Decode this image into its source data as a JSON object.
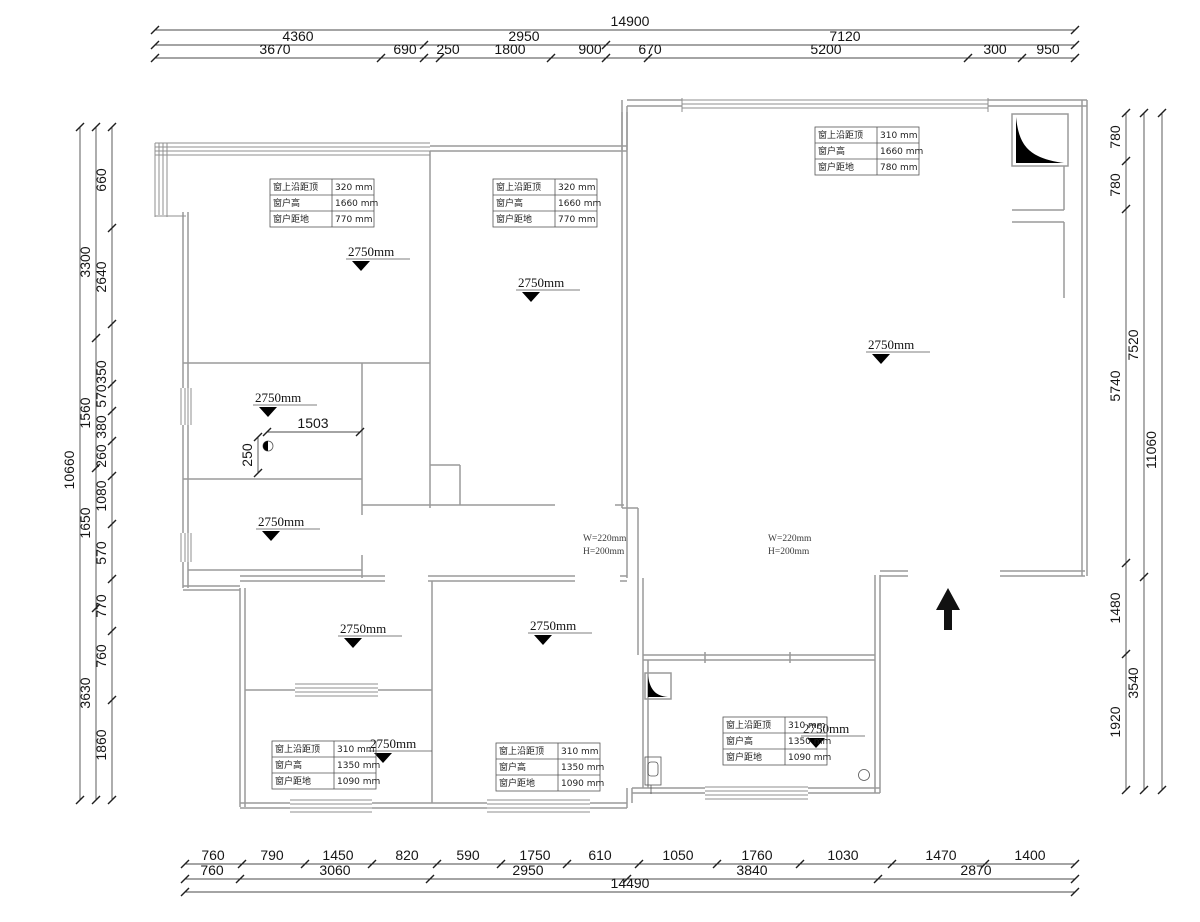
{
  "meta": {
    "drawing_type": "residential floor plan (ceiling/window heights)",
    "units": "mm"
  },
  "palette": {
    "wall": "#9a9a9a",
    "dim_text": "#151515",
    "solid": "#000000",
    "background": "#ffffff"
  },
  "dim_chains": [
    {
      "id": "top-overall",
      "orient": "h",
      "line": {
        "x1": 155,
        "x2": 1075,
        "y": 30
      },
      "ticks": [
        155,
        1075
      ],
      "labels": [
        {
          "v": "14900",
          "x": 630
        }
      ]
    },
    {
      "id": "top-mid",
      "orient": "h",
      "line": {
        "x1": 155,
        "x2": 1075,
        "y": 45
      },
      "ticks": [
        155,
        424,
        606,
        1075
      ],
      "labels": [
        {
          "v": "4360",
          "x": 298
        },
        {
          "v": "2950",
          "x": 524
        },
        {
          "v": "7120",
          "x": 845
        }
      ]
    },
    {
      "id": "top-detail",
      "orient": "h",
      "line": {
        "x1": 155,
        "x2": 1075,
        "y": 58
      },
      "ticks": [
        155,
        381,
        424,
        440,
        551,
        606,
        648,
        968,
        1022,
        1075
      ],
      "labels": [
        {
          "v": "3670",
          "x": 275
        },
        {
          "v": "690",
          "x": 405
        },
        {
          "v": "250",
          "x": 448
        },
        {
          "v": "1800",
          "x": 510
        },
        {
          "v": "900",
          "x": 590
        },
        {
          "v": "670",
          "x": 650
        },
        {
          "v": "5200",
          "x": 826
        },
        {
          "v": "300",
          "x": 995
        },
        {
          "v": "950",
          "x": 1048
        }
      ]
    },
    {
      "id": "bottom-detail",
      "orient": "h",
      "line": {
        "x1": 185,
        "x2": 1075,
        "y": 864
      },
      "ticks": [
        185,
        242,
        305,
        372,
        437,
        501,
        567,
        639,
        717,
        800,
        892,
        985,
        1075
      ],
      "labels": [
        {
          "v": "760",
          "x": 213
        },
        {
          "v": "790",
          "x": 272
        },
        {
          "v": "1450",
          "x": 338
        },
        {
          "v": "820",
          "x": 407
        },
        {
          "v": "590",
          "x": 468
        },
        {
          "v": "1750",
          "x": 535
        },
        {
          "v": "610",
          "x": 600
        },
        {
          "v": "1050",
          "x": 678
        },
        {
          "v": "1760",
          "x": 757
        },
        {
          "v": "1030",
          "x": 843
        },
        {
          "v": "1470",
          "x": 941
        },
        {
          "v": "1400",
          "x": 1030
        }
      ]
    },
    {
      "id": "bottom-mid",
      "orient": "h",
      "line": {
        "x1": 185,
        "x2": 1075,
        "y": 879
      },
      "ticks": [
        185,
        240,
        430,
        627,
        878,
        1075
      ],
      "labels": [
        {
          "v": "760",
          "x": 212
        },
        {
          "v": "3060",
          "x": 335
        },
        {
          "v": "2950",
          "x": 528
        },
        {
          "v": "3840",
          "x": 752
        },
        {
          "v": "2870",
          "x": 976
        }
      ]
    },
    {
      "id": "bottom-overall",
      "orient": "h",
      "line": {
        "x1": 185,
        "x2": 1075,
        "y": 892
      },
      "ticks": [
        185,
        1075
      ],
      "labels": [
        {
          "v": "14490",
          "x": 630
        }
      ]
    },
    {
      "id": "left-overall",
      "orient": "v",
      "line": {
        "x": 80,
        "y1": 127,
        "y2": 800
      },
      "ticks": [
        127,
        800
      ],
      "labels": [
        {
          "v": "10660",
          "y": 470
        }
      ]
    },
    {
      "id": "left-mid",
      "orient": "v",
      "line": {
        "x": 96,
        "y1": 127,
        "y2": 800
      },
      "ticks": [
        127,
        338,
        468,
        608,
        800
      ],
      "labels": [
        {
          "v": "3300",
          "y": 262
        },
        {
          "v": "1560",
          "y": 413
        },
        {
          "v": "1650",
          "y": 523
        },
        {
          "v": "3630",
          "y": 693
        }
      ]
    },
    {
      "id": "left-detail",
      "orient": "v",
      "line": {
        "x": 112,
        "y1": 127,
        "y2": 800
      },
      "ticks": [
        127,
        228,
        324,
        384,
        411,
        441,
        476,
        524,
        579,
        631,
        700,
        800
      ],
      "labels": [
        {
          "v": "660",
          "y": 180
        },
        {
          "v": "2640",
          "y": 277
        },
        {
          "v": "350",
          "y": 372
        },
        {
          "v": "570",
          "y": 396
        },
        {
          "v": "380",
          "y": 427
        },
        {
          "v": "260",
          "y": 456
        },
        {
          "v": "1080",
          "y": 496
        },
        {
          "v": "570",
          "y": 553
        },
        {
          "v": "770",
          "y": 606
        },
        {
          "v": "760",
          "y": 656
        },
        {
          "v": "1860",
          "y": 745
        }
      ]
    },
    {
      "id": "right-inner",
      "orient": "v",
      "line": {
        "x": 1126,
        "y1": 113,
        "y2": 790
      },
      "ticks": [
        113,
        161,
        209,
        563,
        654,
        790
      ],
      "labels": [
        {
          "v": "780",
          "y": 137
        },
        {
          "v": "780",
          "y": 185
        },
        {
          "v": "5740",
          "y": 386
        },
        {
          "v": "1480",
          "y": 608
        },
        {
          "v": "1920",
          "y": 722
        }
      ]
    },
    {
      "id": "right-mid",
      "orient": "v",
      "line": {
        "x": 1144,
        "y1": 113,
        "y2": 790
      },
      "ticks": [
        113,
        577,
        790
      ],
      "labels": [
        {
          "v": "7520",
          "y": 345
        },
        {
          "v": "3540",
          "y": 683
        }
      ]
    },
    {
      "id": "right-overall",
      "orient": "v",
      "line": {
        "x": 1162,
        "y1": 113,
        "y2": 790
      },
      "ticks": [
        113,
        790
      ],
      "labels": [
        {
          "v": "11060",
          "y": 450
        }
      ]
    },
    {
      "id": "room-d-width",
      "orient": "h",
      "line": {
        "x1": 267,
        "x2": 360,
        "y": 432
      },
      "ticks": [
        267,
        360
      ],
      "labels": [
        {
          "v": "1503",
          "x": 313
        }
      ]
    },
    {
      "id": "room-d-offset",
      "orient": "v",
      "line": {
        "x": 258,
        "y1": 437,
        "y2": 473
      },
      "ticks": [
        437,
        473
      ],
      "labels": [
        {
          "v": "250",
          "y": 455
        }
      ]
    }
  ],
  "ceiling_markers": [
    {
      "label": "2750mm",
      "x": 348,
      "y": 246
    },
    {
      "label": "2750mm",
      "x": 518,
      "y": 277
    },
    {
      "label": "2750mm",
      "x": 868,
      "y": 339
    },
    {
      "label": "2750mm",
      "x": 255,
      "y": 392
    },
    {
      "label": "2750mm",
      "x": 258,
      "y": 516
    },
    {
      "label": "2750mm",
      "x": 340,
      "y": 623
    },
    {
      "label": "2750mm",
      "x": 370,
      "y": 738
    },
    {
      "label": "2750mm",
      "x": 530,
      "y": 620
    },
    {
      "label": "2750mm",
      "x": 803,
      "y": 723
    }
  ],
  "beam_labels": [
    {
      "lines": [
        "W=220mm",
        "H=200mm"
      ],
      "x": 583,
      "y": 541
    },
    {
      "lines": [
        "W=220mm",
        "H=200mm"
      ],
      "x": 768,
      "y": 541
    }
  ],
  "window_tables": [
    {
      "x": 270,
      "y": 179,
      "rows": [
        {
          "k": "窗上沿距顶",
          "v": "320 mm"
        },
        {
          "k": "窗户高",
          "v": "1660 mm"
        },
        {
          "k": "窗户距地",
          "v": "770 mm"
        }
      ]
    },
    {
      "x": 493,
      "y": 179,
      "rows": [
        {
          "k": "窗上沿距顶",
          "v": "320 mm"
        },
        {
          "k": "窗户高",
          "v": "1660 mm"
        },
        {
          "k": "窗户距地",
          "v": "770 mm"
        }
      ]
    },
    {
      "x": 815,
      "y": 127,
      "rows": [
        {
          "k": "窗上沿距顶",
          "v": "310 mm"
        },
        {
          "k": "窗户高",
          "v": "1660 mm"
        },
        {
          "k": "窗户距地",
          "v": "780 mm"
        }
      ]
    },
    {
      "x": 272,
      "y": 741,
      "rows": [
        {
          "k": "窗上沿距顶",
          "v": "310 mm"
        },
        {
          "k": "窗户高",
          "v": "1350 mm"
        },
        {
          "k": "窗户距地",
          "v": "1090 mm"
        }
      ]
    },
    {
      "x": 496,
      "y": 743,
      "rows": [
        {
          "k": "窗上沿距顶",
          "v": "310 mm"
        },
        {
          "k": "窗户高",
          "v": "1350 mm"
        },
        {
          "k": "窗户距地",
          "v": "1090 mm"
        }
      ]
    },
    {
      "x": 723,
      "y": 717,
      "rows": [
        {
          "k": "窗上沿距顶",
          "v": "310 mm"
        },
        {
          "k": "窗户高",
          "v": "1350 mm"
        },
        {
          "k": "窗户距地",
          "v": "1090 mm"
        }
      ]
    }
  ]
}
